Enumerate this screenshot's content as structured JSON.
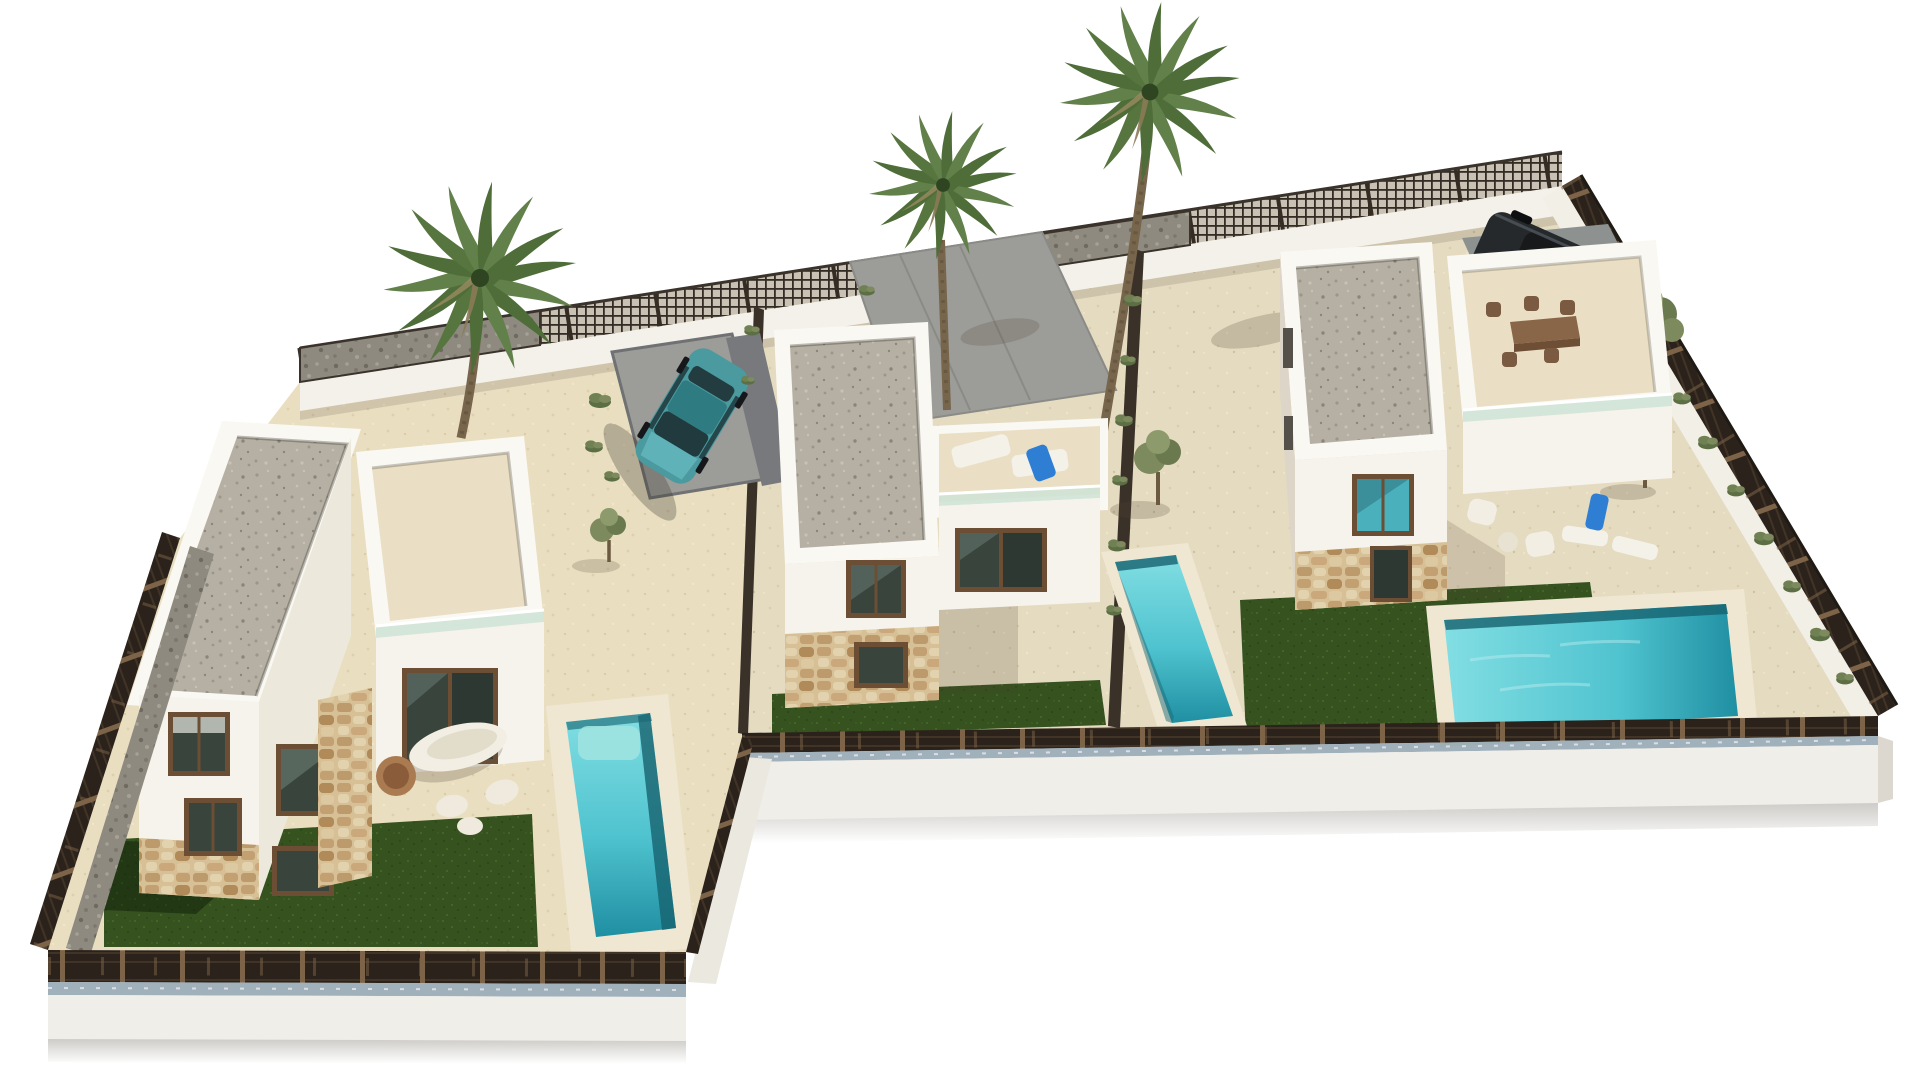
{
  "meta": {
    "type": "3d-architectural-render",
    "description": "Aerial axonometric rendering of a development of three modern white villas with flat gravel roofs, private turquoise pools, artificial lawns, palm trees and a dark perimeter mesh fence on a white model base, isolated on a white background.",
    "background": "#ffffff"
  },
  "scene": {
    "plots": [
      {
        "name": "left-villa-plot",
        "house": "two-storey white villa with flat gravel roof and single-storey wing",
        "features": [
          "stone-clad ground floor",
          "dark framed windows",
          "organic white outdoor furniture set",
          "artificial lawn",
          "private pool with steps",
          "teal hatchback parked on grey pad",
          "fan palm tree",
          "gabion and mesh boundary fence"
        ]
      },
      {
        "name": "middle-villa-plot",
        "house": "two-storey white villa with roof terrace over single-storey wing",
        "features": [
          "two white sun loungers with blue towel on roof terrace",
          "glass balustrade",
          "stone-clad ground floor",
          "artificial lawn strip",
          "private pool",
          "olive tree",
          "empty grey driveway",
          "tall fan palm"
        ]
      },
      {
        "name": "right-villa-plot",
        "house": "two-storey white villa with open dining terrace wing",
        "features": [
          "outdoor dining table with chairs",
          "white lounge chairs and sun loungers",
          "blue towel",
          "L-shaped lawn",
          "large private pool",
          "olive trees",
          "dark SUV parked on grey pad",
          "shrubs along boundary fence",
          "tallest fan palm"
        ]
      }
    ],
    "perimeter": "dark timber-post mesh fence with trellis panels at the rear, set on a white rendered plinth base"
  },
  "colors": {
    "background": "#ffffff",
    "wall_white": "#f6f3ec",
    "wall_shade": "#ece8db",
    "wall_dark": "#ddd6c8",
    "paving": "#e9dec0",
    "sand": "#e5dbc1",
    "paving_light": "#eadfc4",
    "driveway": "#9c9c98",
    "driveway_dark": "#77797c",
    "lawn": "#35521f",
    "pool_light": "#82dee3",
    "pool_mid": "#4fc3cf",
    "pool_deep": "#1f8fa2",
    "pool_shadow": "#16616e",
    "coping": "#efe7d2",
    "glass_rail": "#cfe3d6",
    "window_frame": "#6b4e33",
    "window_glass": "#39443d",
    "window_reflect": "#49b0bc",
    "fence_dark": "#2b231b",
    "fence_post": "#7d6347",
    "footing_stripe": "#8fa3b0",
    "plinth": "#f0eee8",
    "plinth_shade": "#dcd8d0",
    "palm_green": "#4e6d38",
    "palm_green_light": "#61804a",
    "palm_trunk": "#77654c",
    "olive_green": "#7c8a5e",
    "car_teal": "#4a9aa0",
    "car_teal_roof": "#2f7b82",
    "suv_dark": "#26292c",
    "furniture_white": "#f2eee3",
    "furniture_tan": "#aa7a50",
    "table_brown": "#8a6648",
    "towel_blue": "#2e7fd4"
  }
}
